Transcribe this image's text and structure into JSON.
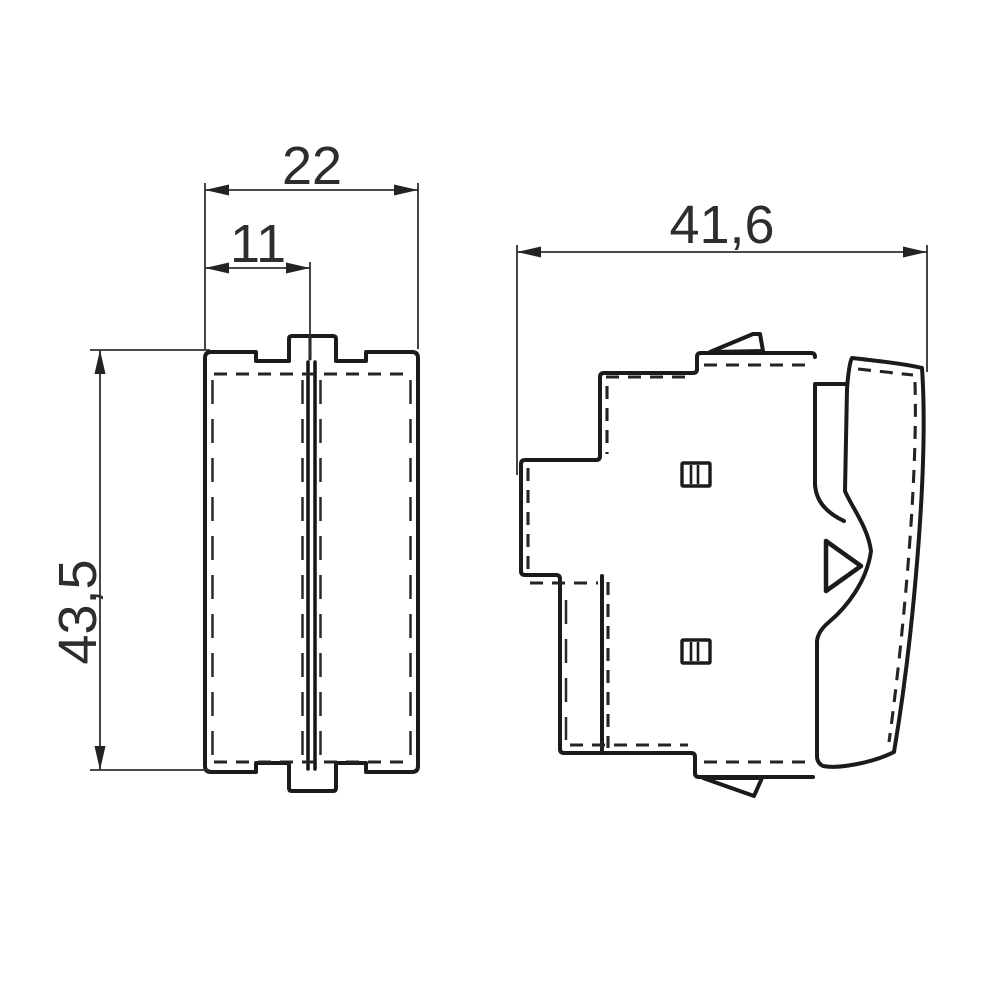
{
  "drawing": {
    "views": {
      "front": "front-view",
      "side": "side-view"
    },
    "dimensions": {
      "front_width": "22",
      "front_center_offset": "11",
      "front_height": "43,5",
      "side_depth": "41,6"
    },
    "symbols": {
      "rocker_indicator": "hollow-triangle-right-icon"
    },
    "colors": {
      "line": "#1b1b1b",
      "dimension_line": "#303030",
      "label_text": "#2d2d2d",
      "background": "#ffffff"
    }
  }
}
